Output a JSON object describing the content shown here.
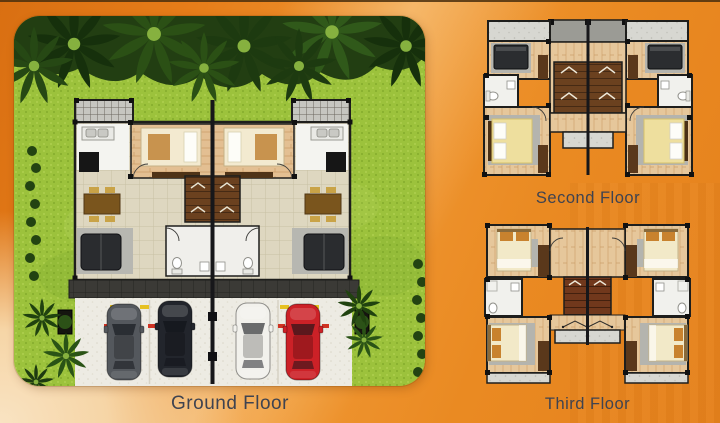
{
  "floors": {
    "ground": {
      "label": "Ground Floor"
    },
    "second": {
      "label": "Second Floor"
    },
    "third": {
      "label": "Third Floor"
    }
  },
  "ground_scene": {
    "cars": [
      {
        "id": "car-1",
        "body_color": "#54585d"
      },
      {
        "id": "car-2",
        "body_color": "#22252c"
      },
      {
        "id": "car-3",
        "body_color": "#f2f1ec"
      },
      {
        "id": "car-4",
        "body_color": "#cc2127"
      }
    ]
  },
  "palette": {
    "background_orange": "#e8861f",
    "background_corner_light": "#f8ddb9",
    "label_text": "#3f4350",
    "grass": "#9cc23c",
    "tree_canopy": "#223e12",
    "tile_floor": "#ded7c0",
    "wood_floor": "#e2bd8f",
    "stair_wood": "#6b411f",
    "bed_cream": "#f2e9c8",
    "bed_yellow": "#eedf9e",
    "wall": "#1e1e1c",
    "concrete": "#d7d7d1"
  }
}
